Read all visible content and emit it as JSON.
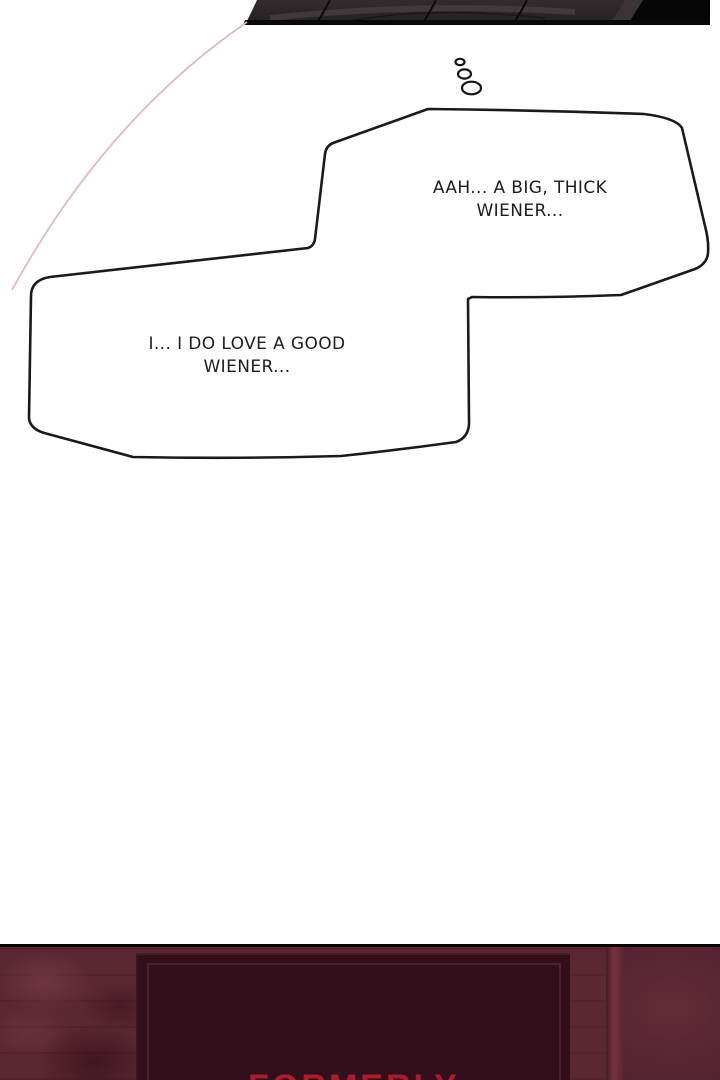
{
  "comic": {
    "thought_trail_icon": "thought-bubble-trail",
    "thought_bubble_1": {
      "line1": "AAH... A BIG, THICK",
      "line2": "WIENER..."
    },
    "thought_bubble_2": {
      "line1": "I... I DO LOVE A GOOD",
      "line2": "WIENER..."
    },
    "bottom_sign": {
      "text": "FORMERLY"
    },
    "colors": {
      "bubble_outline": "#1a1a1a",
      "bubble_fill": "#ffffff",
      "pink_speed_line": "#ddb9c9",
      "top_panel_dark": "#2b2527",
      "wall_maroon": "#5b2733",
      "sign_background": "#310f1b",
      "sign_text_red": "#a81e2e"
    }
  }
}
